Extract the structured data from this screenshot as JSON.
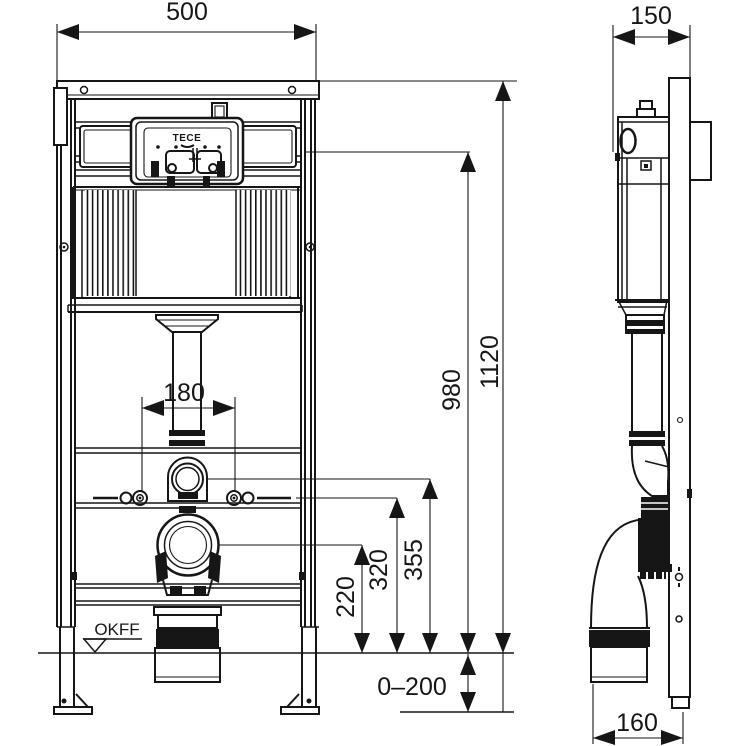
{
  "colors": {
    "line": "#161616",
    "background": "#ffffff"
  },
  "front_view": {
    "dim_width": "500",
    "dim_bolt_spacing": "180",
    "dim_total_height": "1120",
    "dim_panel_height": "980",
    "dim_water_supply_height": "355",
    "dim_fixing_height": "320",
    "dim_outlet_height": "220",
    "dim_foot_adjustment": "0–200",
    "floor_label": "OKFF",
    "brand": "TECE"
  },
  "side_view": {
    "dim_depth": "150",
    "dim_outlet_offset": "160"
  }
}
